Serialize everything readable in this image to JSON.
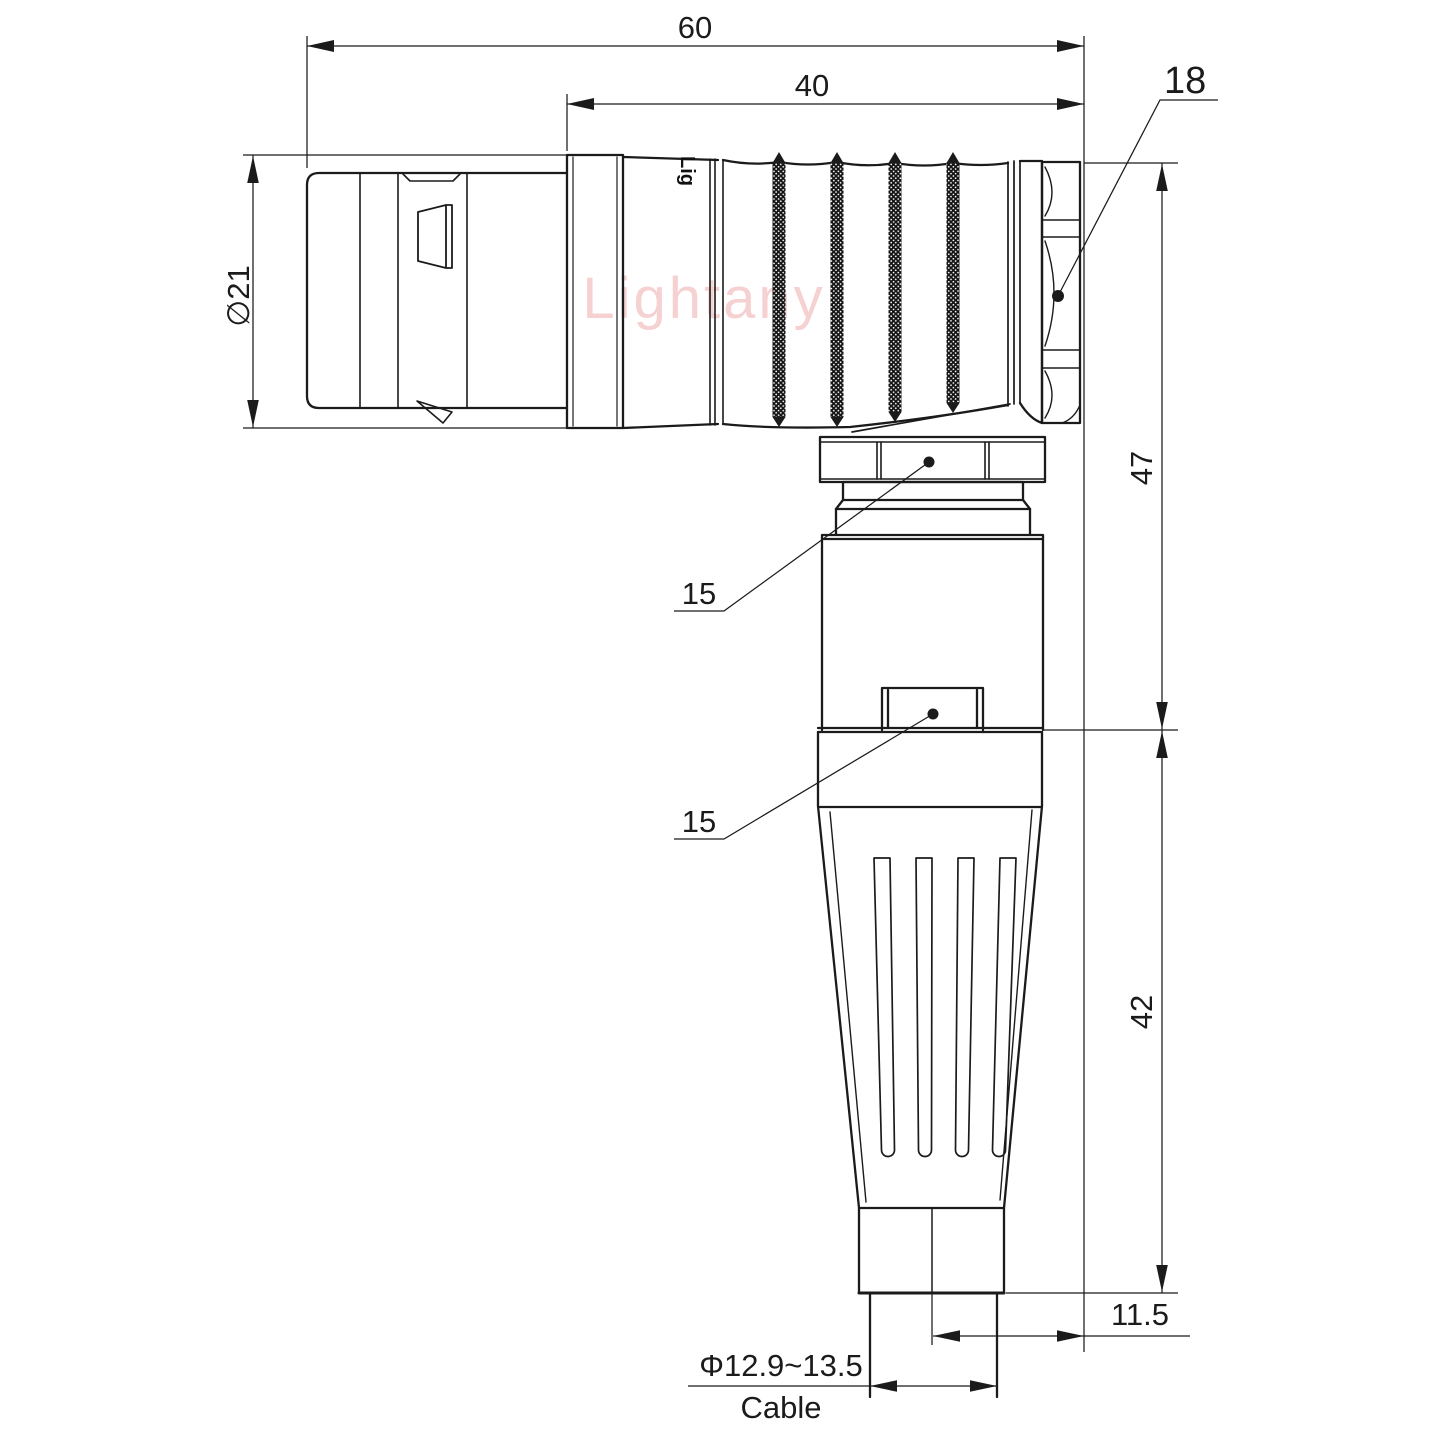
{
  "watermark_text": "Lightany",
  "body_marking": "Lig",
  "dims": {
    "overall_length": "60",
    "body_length": "40",
    "nut_across_flats": "18",
    "shell_diameter": "∅21",
    "height_upper": "47",
    "callout_upper": "15",
    "callout_lower": "15",
    "height_lower": "42",
    "cable_offset": "11.5",
    "cable_diameter_range": "Φ12.9~13.5",
    "cable_label": "Cable"
  },
  "colors": {
    "line": "#1b1b1b",
    "watermark": "#f2c2c3"
  }
}
